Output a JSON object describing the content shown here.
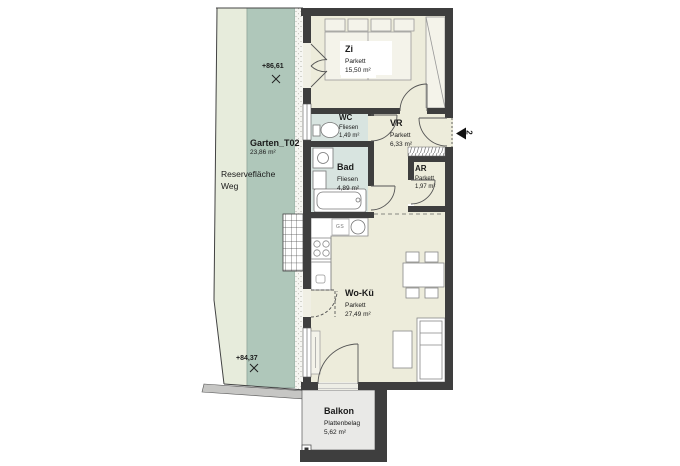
{
  "plan": {
    "rooms": [
      {
        "key": "zi",
        "name": "Zi",
        "finish": "Parkett",
        "area": "15,50 m²"
      },
      {
        "key": "wc",
        "name": "WC",
        "finish": "Fliesen",
        "area": "1,49 m²"
      },
      {
        "key": "vr",
        "name": "VR",
        "finish": "Parkett",
        "area": "6,33 m²"
      },
      {
        "key": "bad",
        "name": "Bad",
        "finish": "Fliesen",
        "area": "4,89 m²"
      },
      {
        "key": "ar",
        "name": "AR",
        "finish": "Parkett",
        "area": "1,97 m²"
      },
      {
        "key": "woku",
        "name": "Wo-Kü",
        "finish": "Parkett",
        "area": "27,49 m²"
      },
      {
        "key": "balkon",
        "name": "Balkon",
        "finish": "Plattenbelag",
        "area": "5,62 m²"
      }
    ],
    "outdoor": {
      "garden_name": "Garten_T02",
      "garden_area": "23,86 m²",
      "reserve_line1": "Reservefläche",
      "reserve_line2": "Weg",
      "elevation_upper": "+86,61",
      "elevation_lower": "+84,37"
    },
    "entrance": {
      "unit_number": "2"
    },
    "kitchen": {
      "dishwasher_label": "GS"
    },
    "colors": {
      "wall": "#3e3e3e",
      "parquet_floor": "#edecdb",
      "tile_floor": "#d8e4e0",
      "garden_light": "#e7ecdc",
      "garden_dark": "#afc7ba",
      "balcony_floor": "#e9e9e7"
    }
  }
}
